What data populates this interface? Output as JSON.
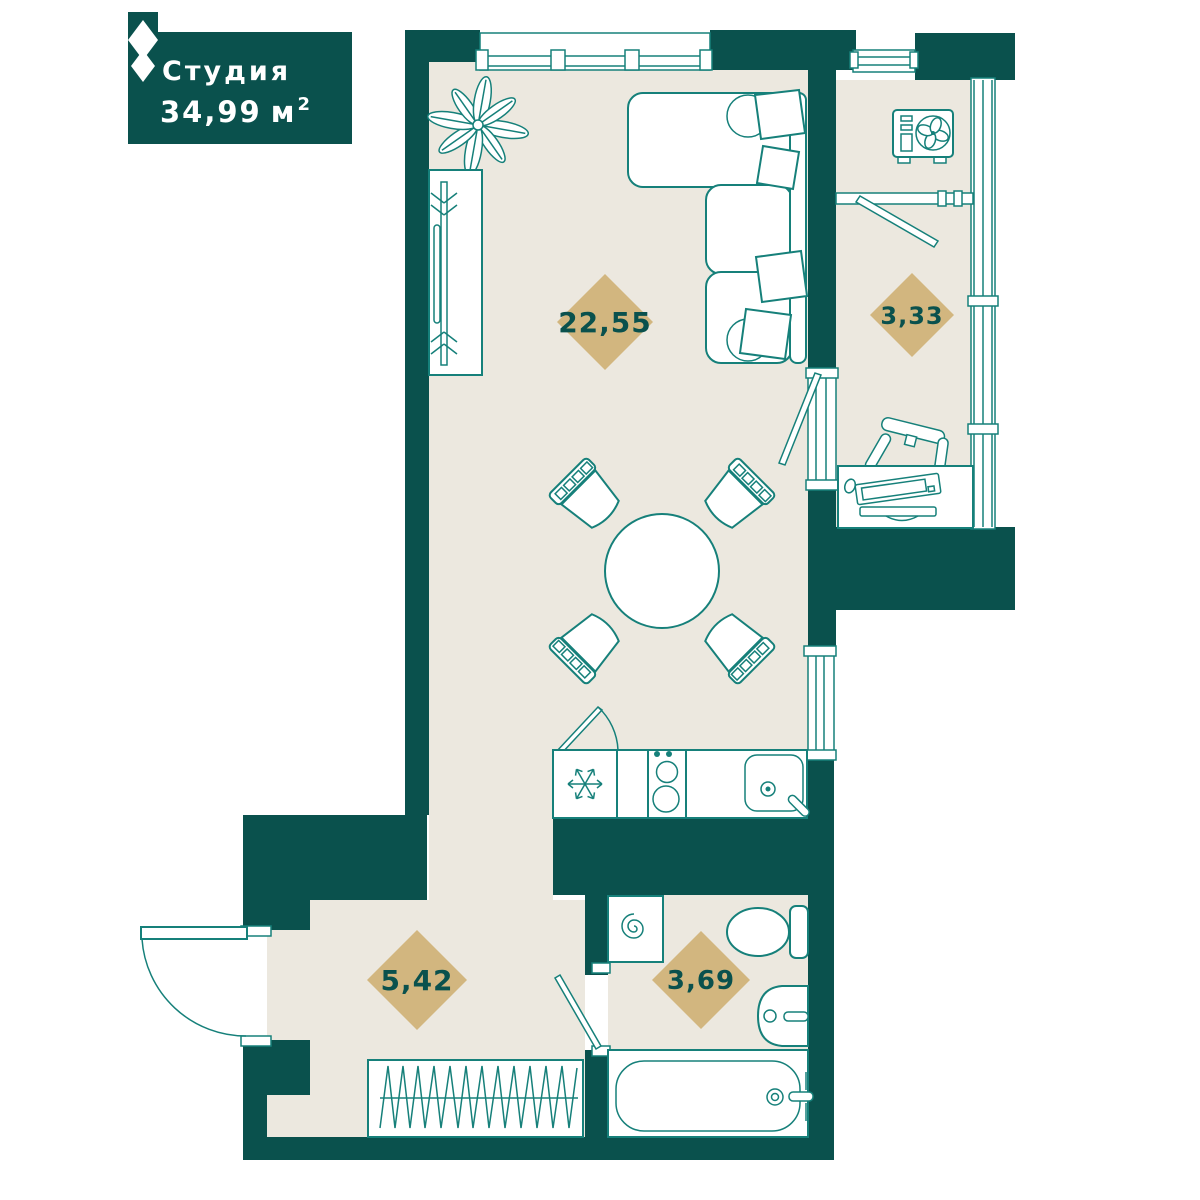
{
  "card": {
    "title": "Студия",
    "area_value": "34,99",
    "area_unit": "м",
    "area_sup": "2"
  },
  "rooms": {
    "living": {
      "label": "living-room",
      "area": "22,55"
    },
    "balcony": {
      "label": "balcony",
      "area": "3,33"
    },
    "hallway": {
      "label": "hallway",
      "area": "5,42"
    },
    "bathroom": {
      "label": "bathroom",
      "area": "3,69"
    }
  },
  "colors": {
    "wall": "#0a514d",
    "floor": "#ece8df",
    "line": "#16807a",
    "diamond": "#d2b67f",
    "diamond_text": "#0a514d",
    "card_bg": "#0a514d",
    "card_text": "#ffffff"
  },
  "icons": [
    "brand-diamond-icon",
    "plant-icon",
    "wardrobe-icon",
    "sofa-icon",
    "pillow-icon",
    "dining-table-icon",
    "chair-icon",
    "fridge-icon",
    "stove-icon",
    "kitchen-sink-icon",
    "door-icon",
    "washing-machine-icon",
    "toilet-icon",
    "wash-basin-icon",
    "bathtub-icon",
    "coat-rack-icon",
    "desk-icon",
    "monitor-icon",
    "office-chair-icon",
    "air-conditioner-icon",
    "window-icon",
    "glazing-icon"
  ]
}
